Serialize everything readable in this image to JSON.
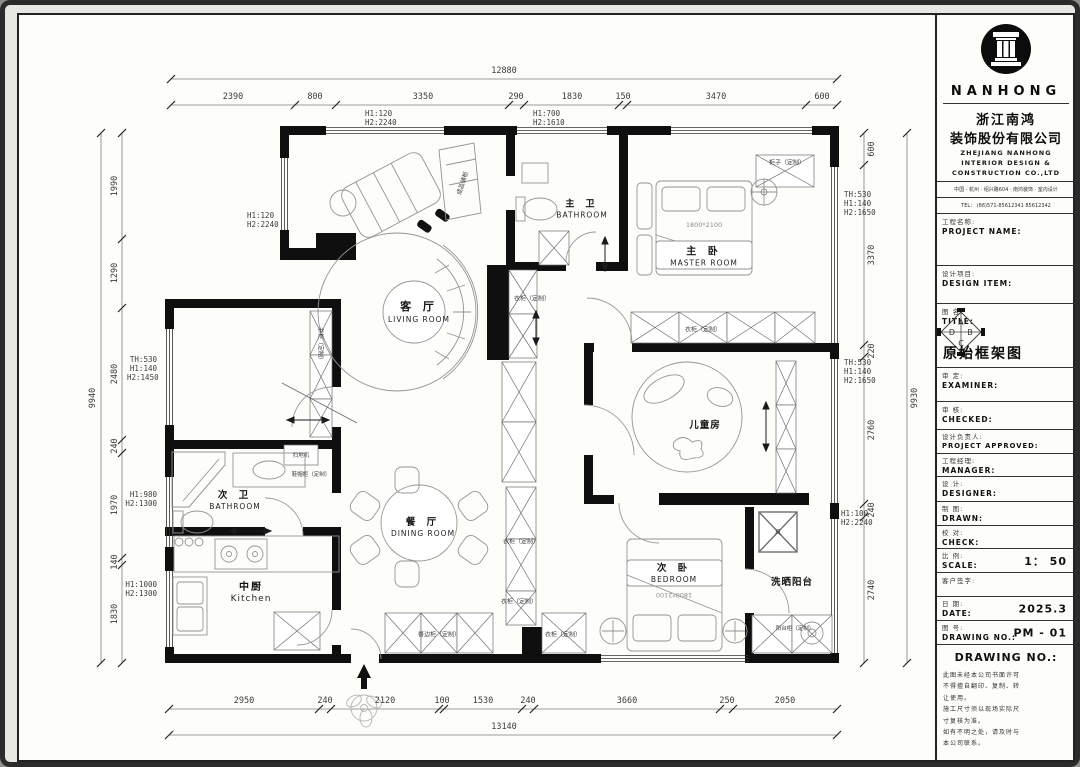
{
  "plan": {
    "dims": {
      "top_total": "12880",
      "top": [
        "2390",
        "800",
        "3350",
        "290",
        "1830",
        "150",
        "3470",
        "600"
      ],
      "bottom": [
        "2950",
        "240",
        "2120",
        "100",
        "1530",
        "240",
        "3660",
        "250",
        "2050"
      ],
      "bottom_total": "13140",
      "left_total": "9940",
      "left": [
        "1990",
        "1290",
        "2480",
        "240",
        "1970",
        "140",
        "1830"
      ],
      "right": [
        "600",
        "3370",
        "220",
        "2760",
        "240",
        "2740"
      ],
      "right_total": "9930"
    },
    "annotations": {
      "top1": [
        "H1:120",
        "H2:2240"
      ],
      "top2": [
        "H1:700",
        "H2:1610"
      ],
      "left_wall": [
        "H1:120",
        "H2:2240"
      ],
      "left1": [
        "TH:530",
        "H1:140",
        "H2:1450"
      ],
      "left2": [
        "H1:980",
        "H2:1300"
      ],
      "left3": [
        "H1:1000",
        "H2:1300"
      ],
      "right1": [
        "TH:530",
        "H1:140",
        "H2:1650"
      ],
      "right2": [
        "TH:530",
        "H1:140",
        "H2:1650"
      ],
      "right3": [
        "H1:100",
        "H2:2240"
      ]
    },
    "rooms": {
      "living": {
        "cn": "客 厅",
        "en": "LIVING ROOM"
      },
      "master_bath": {
        "cn": "主 卫",
        "en": "BATHROOM"
      },
      "master": {
        "cn": "主 卧",
        "en": "MASTER ROOM",
        "bed": "1800*2100"
      },
      "kids": {
        "cn": "儿童房"
      },
      "second_bath": {
        "cn": "次 卫",
        "en": "BATHROOM"
      },
      "kitchen": {
        "cn": "中厨",
        "en": "Kitchen"
      },
      "dining": {
        "cn": "餐 厅",
        "en": "DINING ROOM"
      },
      "bedroom2": {
        "cn": "次 卧",
        "en": "BEDROOM",
        "bed": "1800*2100"
      },
      "balcony": {
        "cn": "洗晒阳台"
      }
    },
    "labels": {
      "storage": "成品储柜",
      "wardrobe": "衣柜（定制）",
      "cabinet": "柜子（定制）",
      "bookcase": "书柜（定制）",
      "vacuum": "扫地机",
      "shoe": "鞋帽柜（定制）",
      "sideboard": "餐边柜（定制）",
      "balcony_cab": "阳台柜（定制）",
      "duct": "风"
    }
  },
  "title_block": {
    "brand": "NANHONG",
    "company_cn1": "浙江南鸿",
    "company_cn2": "装饰股份有限公司",
    "company_en1": "ZHEJIANG NANHONG",
    "company_en2": "INTERIOR DESIGN &",
    "company_en3": "CONSTRUCTION CO.,LTD",
    "address": "中国 · 杭州 · 绍兴路604 · 南鸿装饰 · 室内设计",
    "tel": "TEL： (86)571-85612341  85612342",
    "fields": {
      "project": {
        "cn": "工程名称:",
        "en": "PROJECT NAME:"
      },
      "design_item": {
        "cn": "设计项目:",
        "en": "DESIGN ITEM:"
      },
      "title": {
        "cn": "图  名:",
        "en": "TITLE:",
        "value": "原始框架图"
      },
      "examiner": {
        "cn": "审  定:",
        "en": "EXAMINER:"
      },
      "checked": {
        "cn": "审  核:",
        "en": "CHECKED:"
      },
      "approved": {
        "cn": "设计负责人:",
        "en": "PROJECT APPROVED:"
      },
      "manager": {
        "cn": "工程经理:",
        "en": "MANAGER:"
      },
      "designer": {
        "cn": "设  计:",
        "en": "DESIGNER:"
      },
      "drawn": {
        "cn": "制  图:",
        "en": "DRAWN:"
      },
      "check": {
        "cn": "校  对:",
        "en": "CHECK:"
      },
      "scale": {
        "cn": "比  例:",
        "en": "SCALE:",
        "value": "1： 50"
      },
      "client": {
        "cn": "客户签字:"
      },
      "date": {
        "cn": "日  期:",
        "en": "DATE:",
        "value": "2025.3"
      },
      "drawing_no": {
        "cn": "图  号:",
        "en": "DRAWING NO.:",
        "value": "PM - 01"
      }
    },
    "notes_title": "DRAWING NO.:",
    "notes": [
      "此图未经本公司书面许可",
      "不得擅自翻印、复制、转",
      "让使用。",
      "施工尺寸须以现场实际尺",
      "寸复核为准。",
      "如有不明之处，请及时与",
      "本公司联系。"
    ],
    "diamond": [
      "A",
      "B",
      "C",
      "D"
    ]
  }
}
